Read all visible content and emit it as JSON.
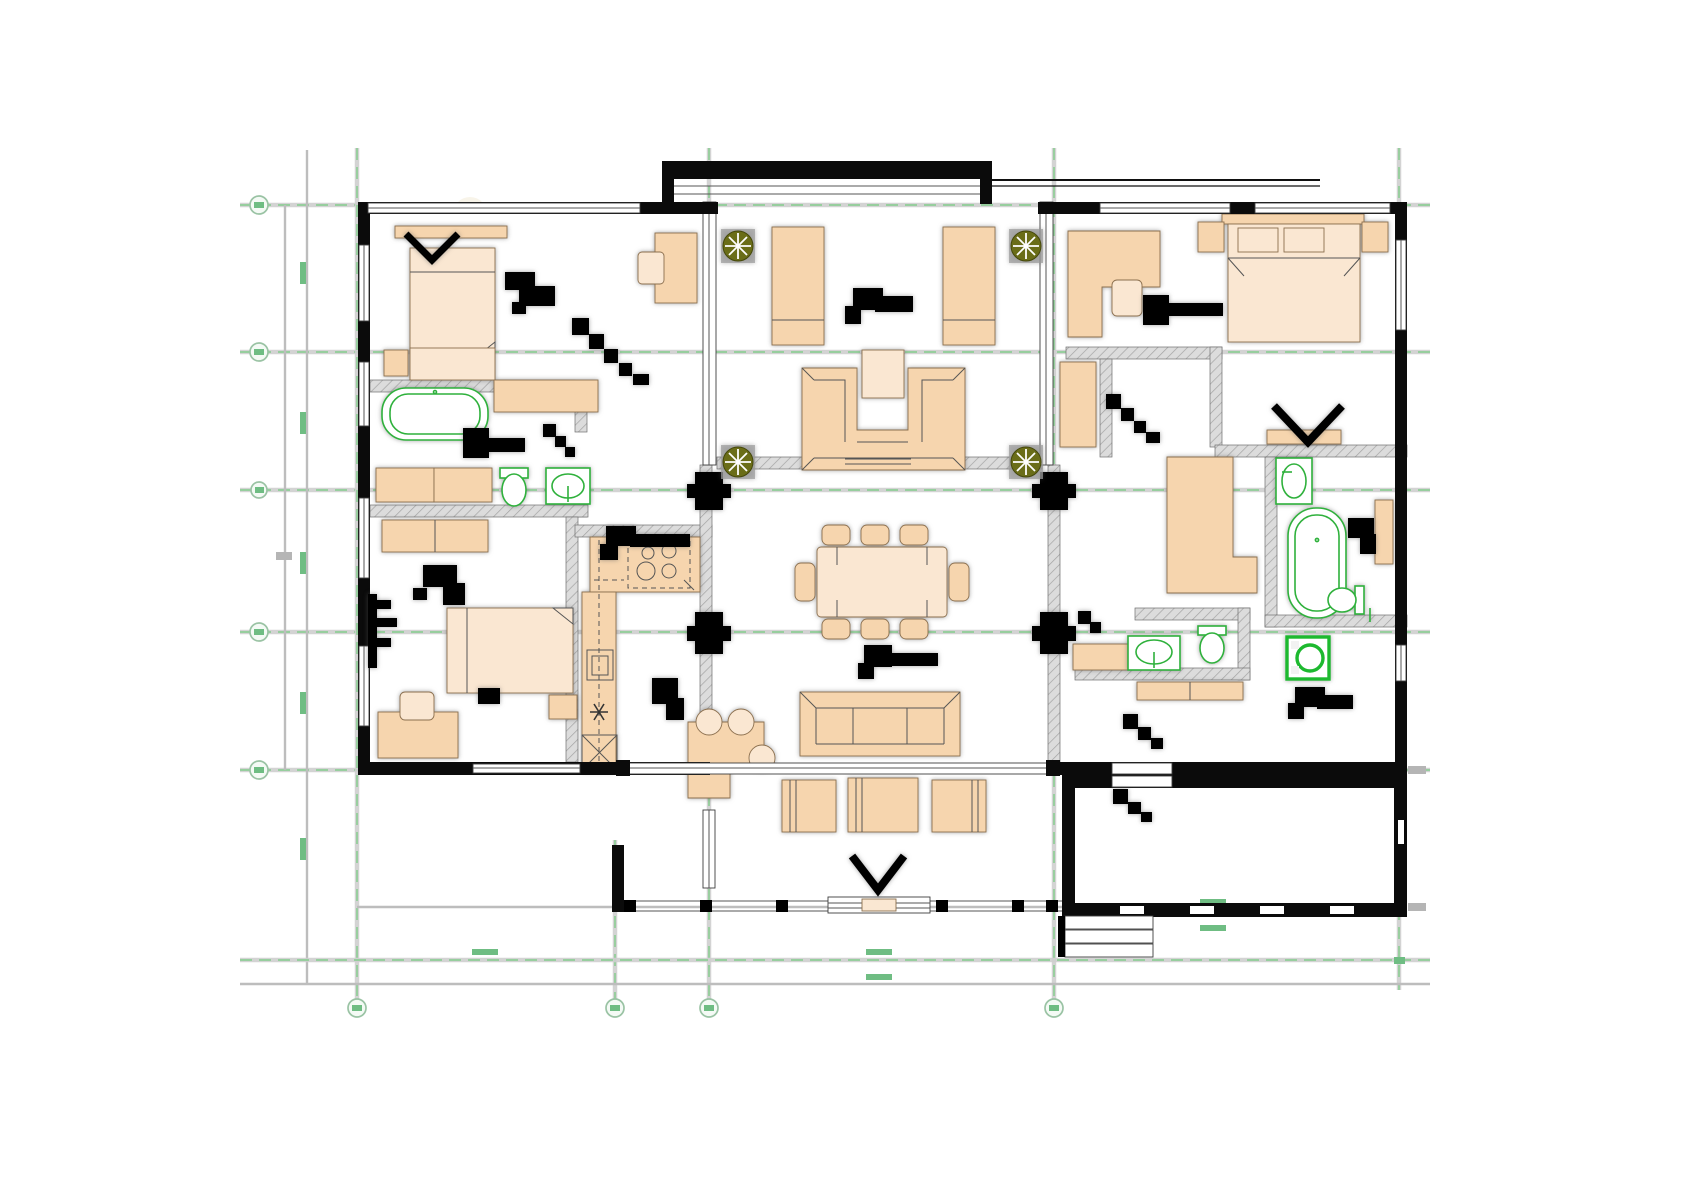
{
  "document": {
    "title": "Furnished architectural floor plan",
    "drawing_type": "ground floor furniture layout plan"
  },
  "palette": {
    "wall_black": "#0b0b0b",
    "interior_wall_gray": "#dcdcdc",
    "furniture_peach": "#F6D5AE",
    "furniture_light": "#FAE7D2",
    "fixture_green": "#2FB13C",
    "grid_green": "#8FCE96",
    "dimension_gray": "#bdbdbd",
    "plant_olive": "#6A6D18"
  },
  "grid": {
    "horizontal_axes": [
      {
        "label": ""
      },
      {
        "label": ""
      },
      {
        "label": ""
      },
      {
        "label": ""
      },
      {
        "label": ""
      }
    ],
    "vertical_axes": [
      {
        "label": ""
      },
      {
        "label": ""
      },
      {
        "label": ""
      },
      {
        "label": ""
      },
      {
        "label": ""
      }
    ]
  },
  "rooms": [
    {
      "name": "bedroom 1",
      "furniture": [
        "double bed",
        "headboard shelf",
        "foot bench",
        "nightstand",
        "desk",
        "chair",
        "ceiling light symbol"
      ]
    },
    {
      "name": "bathroom 1",
      "furniture": [
        "bathtub",
        "vanity counter",
        "cabinets",
        "toilet",
        "washbasin"
      ]
    },
    {
      "name": "bedroom 2",
      "furniture": [
        "wardrobe",
        "double bed",
        "nightstand",
        "desk",
        "chair",
        "pivot door"
      ]
    },
    {
      "name": "kitchen",
      "furniture": [
        "L-shaped counter",
        "4-burner cooktop",
        "oven",
        "sink",
        "refrigerator"
      ]
    },
    {
      "name": "hallway left",
      "furniture": [
        "ceiling light symbol"
      ]
    },
    {
      "name": "entry courtyard",
      "furniture": [
        "planter",
        "planter",
        "planter",
        "planter",
        "daybed",
        "daybed",
        "U-shaped sofa",
        "coffee table"
      ]
    },
    {
      "name": "dining room",
      "furniture": [
        "dining table",
        "8 chairs",
        "ceiling light symbol"
      ]
    },
    {
      "name": "living room",
      "furniture": [
        "3-seat sofa",
        "breakfast table",
        "3 stools"
      ]
    },
    {
      "name": "terrace",
      "furniture": [
        "armchair",
        "armchair",
        "armchair",
        "railing",
        "garden steps"
      ]
    },
    {
      "name": "bedroom 3",
      "furniture": [
        "corner desk",
        "chair",
        "double bed",
        "pillows",
        "nightstand",
        "nightstand",
        "dresser"
      ]
    },
    {
      "name": "walk-in closet",
      "furniture": [
        "wardrobe",
        "door"
      ]
    },
    {
      "name": "bathroom 2",
      "furniture": [
        "washbasin",
        "bathtub",
        "toilet",
        "wardrobe"
      ]
    },
    {
      "name": "laundry",
      "furniture": [
        "washing machine"
      ]
    },
    {
      "name": "wc",
      "furniture": [
        "counter",
        "washbasin",
        "toilet"
      ]
    },
    {
      "name": "hallway right",
      "furniture": [
        "bench",
        "door"
      ]
    },
    {
      "name": "garage room",
      "furniture": [
        "entry steps"
      ]
    }
  ]
}
